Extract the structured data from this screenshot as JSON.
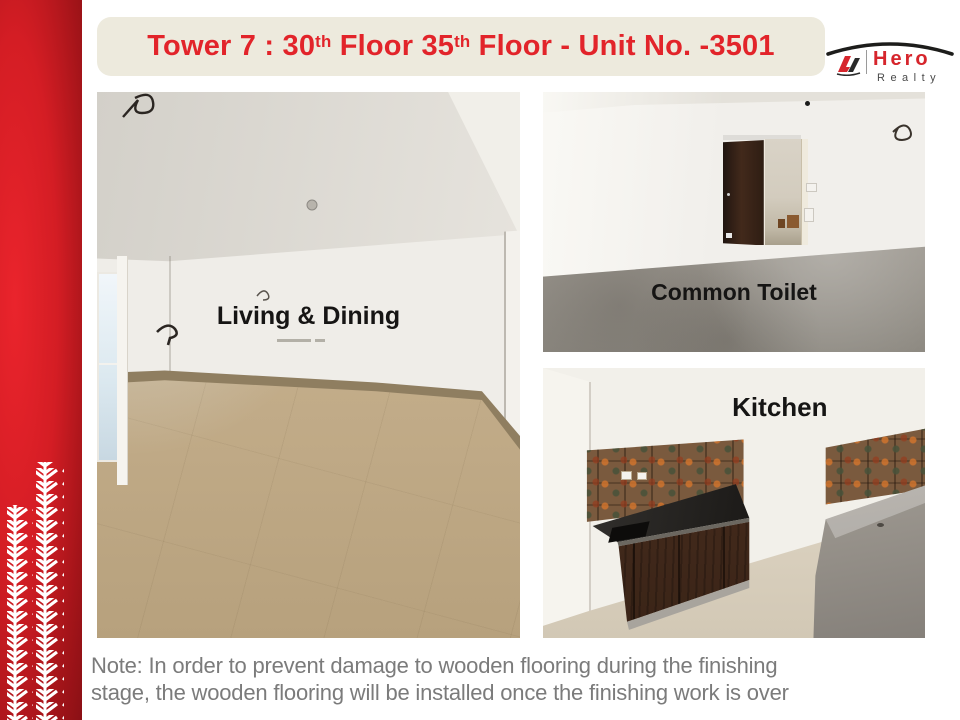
{
  "slide": {
    "title": {
      "part1": "Tower 7 : 30",
      "sup1": "th",
      "part2": " Floor 35",
      "sup2": "th",
      "part3": " Floor - Unit No. -3501"
    },
    "logo": {
      "brand": "Hero",
      "sub": "Realty"
    },
    "photos": {
      "living": {
        "label": "Living & Dining"
      },
      "toilet": {
        "label": "Common Toilet"
      },
      "kitchen": {
        "label": "Kitchen"
      }
    },
    "note": {
      "line1": "Note: In order to prevent damage to wooden flooring during the finishing",
      "line2": "stage, the wooden flooring will be installed once the finishing work is over"
    },
    "colors": {
      "accent_red": "#e2242a",
      "banner_bg": "#edeadd",
      "sidebar_red": "#d41d24",
      "note_gray": "#7b7b7b",
      "label_black": "#161514"
    }
  }
}
